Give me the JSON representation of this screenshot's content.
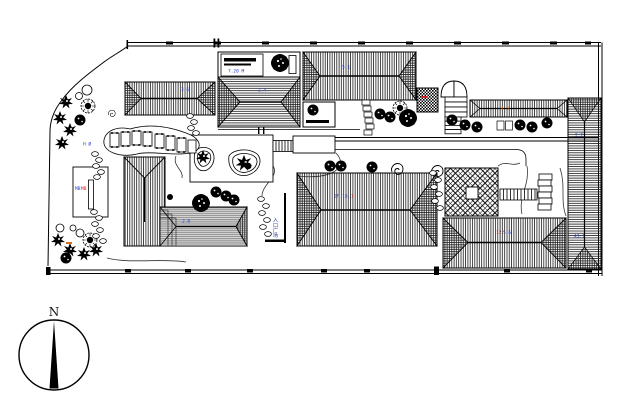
{
  "compass": {
    "north_label": "N"
  },
  "annotations": {
    "parking_box": {
      "text": "7.20 M",
      "color": "#1f3bd4"
    },
    "bldg1": {
      "text": "3.6",
      "color": "#1f3bd4"
    },
    "bldg2": {
      "text": "2.4",
      "color": "#1f3bd4"
    },
    "bldg3": {
      "text": "5.1",
      "color": "#1f3bd4"
    },
    "long_bldg": {
      "text": "4.5",
      "color": "#d4701f"
    },
    "right_bldg_upper": {
      "text": "2.2",
      "color": "#1f3bd4"
    },
    "right_bldg_lower": {
      "text": "43.1",
      "color": "#1f3bd4"
    },
    "mid_bldg_blue": {
      "text": "2F 15.",
      "color": "#1f3bd4"
    },
    "mid_bldg_red": {
      "text": "1",
      "color": "#cc2222"
    },
    "bottom_right_red": {
      "text": "12",
      "color": "#cc2222"
    },
    "bottom_right_blue": {
      "text": "5.6",
      "color": "#1f3bd4"
    },
    "l_bldg": {
      "text": "2.8",
      "color": "#1f3bd4"
    },
    "flag_court_blue": {
      "text": "MB",
      "color": "#1f3bd4"
    },
    "flag_court_red": {
      "text": "MB",
      "color": "#cc2222"
    },
    "lawn": {
      "text": "H Ø",
      "color": "#1f3bd4"
    },
    "entry_vertical": {
      "text": "入口广场",
      "color": "#27359c"
    }
  },
  "colors": {
    "line": "#000000",
    "roof_gray": "#d6d6d6",
    "blue_label": "#1f3bd4",
    "red_label": "#cc2222",
    "orange_label": "#d4701f"
  }
}
